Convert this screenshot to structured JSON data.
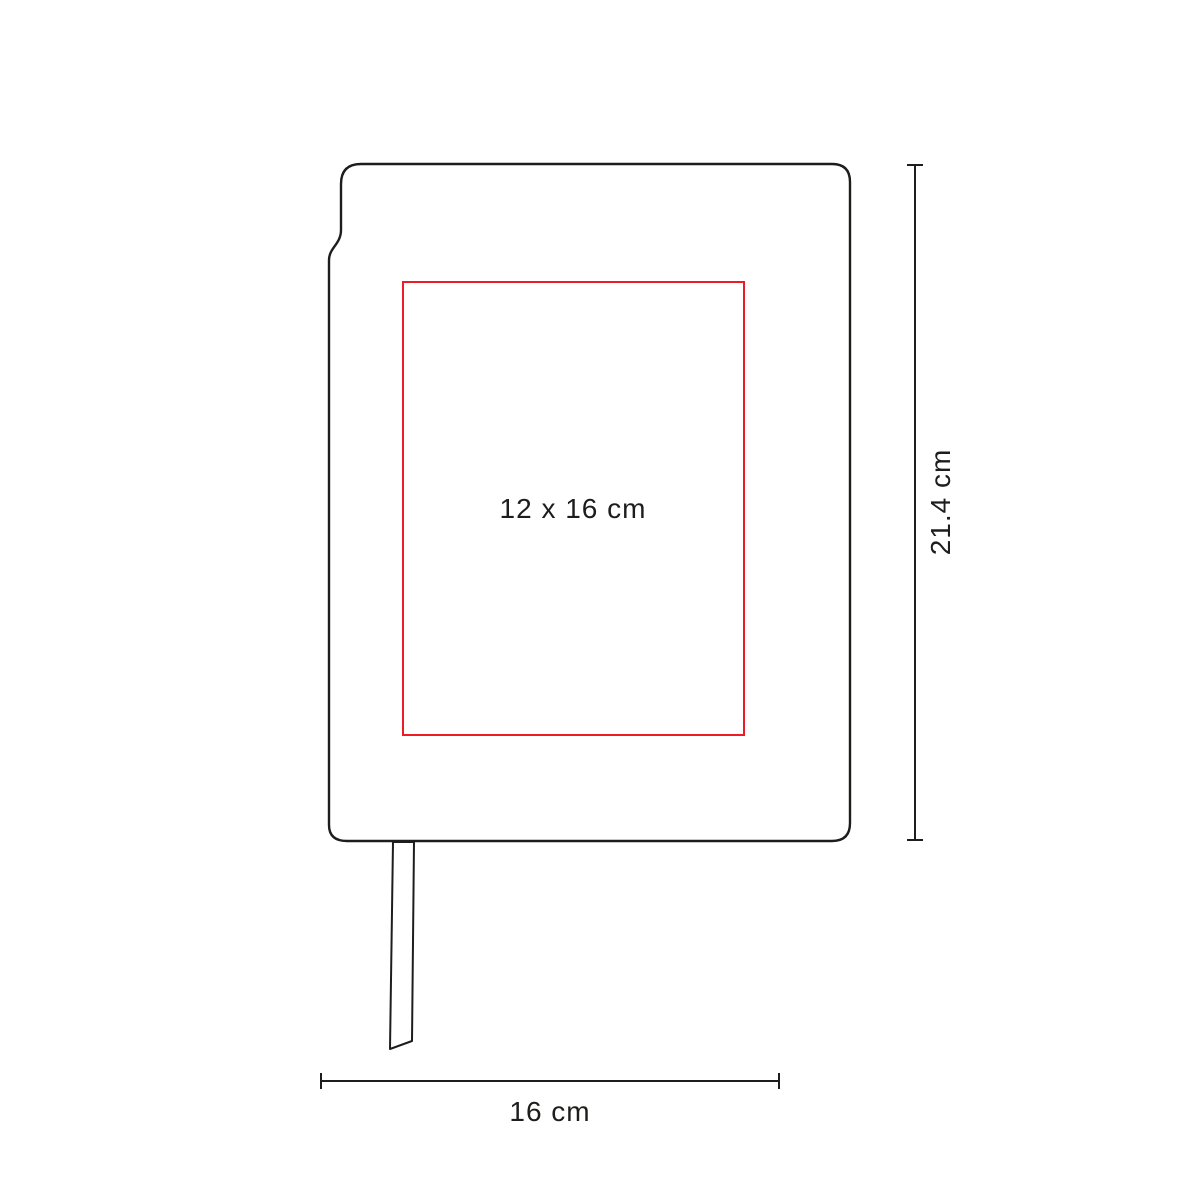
{
  "diagram": {
    "print_area_label": "12 x 16 cm",
    "height_dimension_label": "21.4 cm",
    "width_dimension_label": "16 cm",
    "colors": {
      "outline": "#1d1d1b",
      "print_area": "#ed1c24",
      "background": "#ffffff"
    }
  }
}
